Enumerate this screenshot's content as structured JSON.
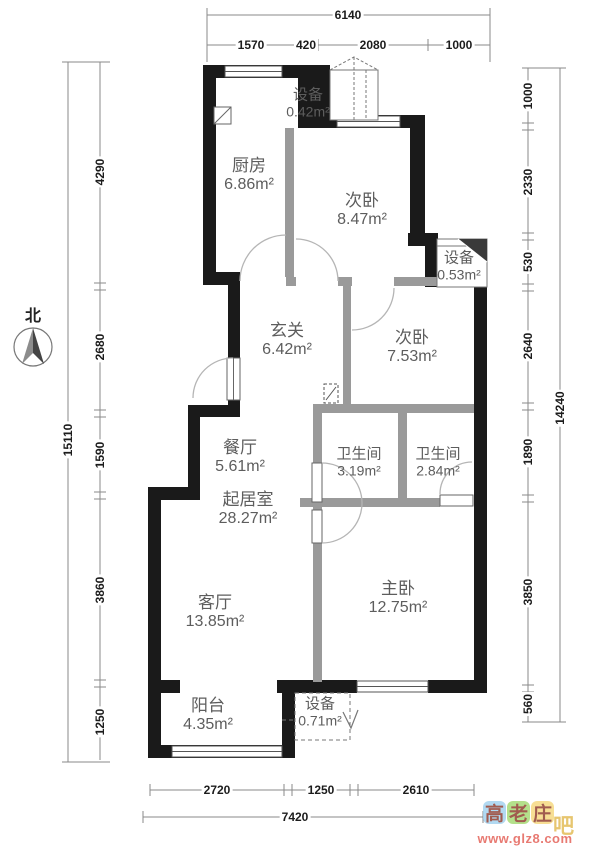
{
  "rooms": {
    "kitchen": {
      "name": "厨房",
      "area": "6.86m²"
    },
    "bedroom2_top": {
      "name": "次卧",
      "area": "8.47m²"
    },
    "bedroom2_mid": {
      "name": "次卧",
      "area": "7.53m²"
    },
    "hallway": {
      "name": "玄关",
      "area": "6.42m²"
    },
    "dining": {
      "name": "餐厅",
      "area": "5.61m²"
    },
    "living_core": {
      "name": "起居室",
      "area": "28.27m²"
    },
    "bath1": {
      "name": "卫生间",
      "area": "3.19m²"
    },
    "bath2": {
      "name": "卫生间",
      "area": "2.84m²"
    },
    "master": {
      "name": "主卧",
      "area": "12.75m²"
    },
    "living": {
      "name": "客厅",
      "area": "13.85m²"
    },
    "balcony": {
      "name": "阳台",
      "area": "4.35m²"
    },
    "shaft_top": {
      "name": "设备",
      "area": "0.42m²"
    },
    "shaft_right": {
      "name": "设备",
      "area": "0.53m²"
    },
    "shaft_bottom": {
      "name": "设备",
      "area": "0.71m²"
    }
  },
  "dimensions": {
    "top": {
      "total": "6140",
      "segments": [
        "1570",
        "420",
        "2080",
        "1000"
      ]
    },
    "left": {
      "total": "15110",
      "segments": [
        "4290",
        "2680",
        "1590",
        "3860",
        "1250"
      ]
    },
    "right": {
      "total": "14240",
      "segments": [
        "1000",
        "2330",
        "530",
        "2640",
        "1890",
        "3850",
        "560"
      ]
    },
    "bottom": {
      "total": "7420",
      "segments": [
        "2720",
        "1250",
        "2610"
      ]
    }
  },
  "compass": {
    "label": "北"
  },
  "watermark": {
    "chars": [
      "高",
      "老",
      "庄"
    ],
    "suffix": "吧",
    "url": "www.glz8.com"
  },
  "colors": {
    "wall": "#1a1a1a",
    "partition": "#9a9a9a",
    "dim_line": "#8a8a8a",
    "tile_blue": "#9fd0ee",
    "tile_green": "#a2d96f",
    "tile_yellow": "#f6d77a"
  }
}
